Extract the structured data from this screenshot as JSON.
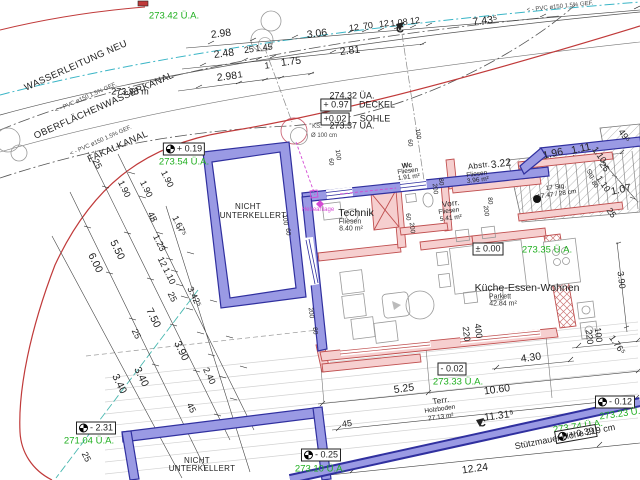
{
  "colors": {
    "wall_new_blue": "#9a9ae4",
    "wall_blue_edge": "#30309f",
    "wall_existing_pink": "#f6cfcf",
    "wall_pink_edge": "#c05050",
    "level_green": "#1faf1f",
    "boundary_red": "#c03a3a",
    "water_cyan": "#3ab5c6",
    "sewer_magenta": "#d44ad4",
    "hatch_gray": "#bbbbbb",
    "dim_black": "#333333",
    "drain_teal": "#49b8b0"
  },
  "labels": [
    {
      "n": "wasserleitung-label",
      "t": "WASSERLEITUNG NEU",
      "x": 76,
      "y": 66,
      "r": -24,
      "c": "util"
    },
    {
      "n": "pvc-note-1",
      "t": "< - PVC ø150 1.5% GEF.",
      "x": 86,
      "y": 98,
      "r": -24,
      "c": "t6"
    },
    {
      "n": "oberflaechenwasserkanal-label",
      "t": "OBERFLÄCHENWASSERKANAL",
      "x": 104,
      "y": 106,
      "r": -24,
      "c": "util"
    },
    {
      "n": "pvc-note-2",
      "t": "< - PVC ø150 1.5% GEF.",
      "x": 101,
      "y": 141,
      "r": -24,
      "c": "t6"
    },
    {
      "n": "faekalkanal-label",
      "t": "FÄKALKANAL",
      "x": 118,
      "y": 147,
      "r": -24,
      "c": "util"
    },
    {
      "n": "pvc-note-3",
      "t": "< - PVC ø150 1.5% GEF.",
      "x": 560,
      "y": 7,
      "r": -6,
      "c": "t6"
    },
    {
      "n": "level-27342",
      "t": "273.42 Ü.A.",
      "x": 174,
      "y": 16,
      "r": 0,
      "c": "g"
    },
    {
      "n": "level-27338",
      "t": "273.38 m",
      "x": 130,
      "y": 92,
      "r": 0,
      "c": "dim"
    },
    {
      "n": "level-box-019",
      "t": "+ 0.19",
      "x": 184,
      "y": 149,
      "r": 0,
      "c": "box",
      "m": true
    },
    {
      "n": "level-27354",
      "t": "273.54 Ü.A.",
      "x": 184,
      "y": 162,
      "r": 0,
      "c": "g"
    },
    {
      "n": "level-box-000",
      "t": "± 0.00",
      "x": 488,
      "y": 249,
      "r": 0,
      "c": "box"
    },
    {
      "n": "level-27335",
      "t": "273.35 Ü.A.",
      "x": 547,
      "y": 250,
      "r": 0,
      "c": "g"
    },
    {
      "n": "level-box-m002",
      "t": "- 0.02",
      "x": 452,
      "y": 369,
      "r": 0,
      "c": "box"
    },
    {
      "n": "level-27333",
      "t": "273.33 Ü.A.",
      "x": 458,
      "y": 382,
      "r": 0,
      "c": "g"
    },
    {
      "n": "level-box-m025",
      "t": "- 0.25",
      "x": 321,
      "y": 455,
      "r": 0,
      "c": "box",
      "m": true
    },
    {
      "n": "level-27310",
      "t": "273.10 Ü.A.",
      "x": 320,
      "y": 469,
      "r": 0,
      "c": "g"
    },
    {
      "n": "level-box-m231",
      "t": "- 2.31",
      "x": 96,
      "y": 428,
      "r": 0,
      "c": "box",
      "m": true
    },
    {
      "n": "level-27104",
      "t": "271.04 Ü.A.",
      "x": 89,
      "y": 441,
      "r": 0,
      "c": "g"
    },
    {
      "n": "level-27374",
      "t": "273.74 Ü.A.",
      "x": 578,
      "y": 427,
      "r": -8,
      "c": "g"
    },
    {
      "n": "level-box-m012",
      "t": "- 0.12",
      "x": 615,
      "y": 402,
      "r": 0,
      "c": "box",
      "m": true
    },
    {
      "n": "level-27323",
      "t": "273.23 Ü.A",
      "x": 623,
      "y": 414,
      "r": -8,
      "c": "g"
    },
    {
      "n": "level-box-039",
      "t": "+ 0.39",
      "x": 576,
      "y": 434,
      "r": -10,
      "c": "box",
      "m": true
    },
    {
      "n": "level-27432",
      "t": "274.32 ÜA.",
      "x": 352,
      "y": 96,
      "r": 0,
      "c": "dim"
    },
    {
      "n": "level-box-097",
      "t": "+ 0.97",
      "x": 336,
      "y": 105,
      "r": 0,
      "c": "box"
    },
    {
      "n": "deckel-label",
      "t": "DECKEL",
      "x": 377,
      "y": 105,
      "r": 0,
      "c": "dim"
    },
    {
      "n": "level-box-002",
      "t": "+0.02",
      "x": 335,
      "y": 119,
      "r": 0,
      "c": "box"
    },
    {
      "n": "sohle-label",
      "t": "SOHLE",
      "x": 375,
      "y": 119,
      "r": 0,
      "c": "dim"
    },
    {
      "n": "ks-label",
      "t": "KS.",
      "x": 317,
      "y": 127,
      "r": 0,
      "c": "t6"
    },
    {
      "n": "ks-diameter",
      "t": "Ø 100 cm",
      "x": 324,
      "y": 136,
      "r": 0,
      "c": "t6"
    },
    {
      "n": "level-27337",
      "t": "273.37 ÜA.",
      "x": 352,
      "y": 126,
      "r": 0,
      "c": "dim"
    },
    {
      "n": "room-nicht-1a",
      "t": "NICHT",
      "x": 248,
      "y": 207,
      "r": 0,
      "c": "rs"
    },
    {
      "n": "room-nicht-1b",
      "t": "UNTERKELLERT",
      "x": 253,
      "y": 216,
      "r": 0,
      "c": "rs"
    },
    {
      "n": "room-nicht-2a",
      "t": "NICHT",
      "x": 197,
      "y": 461,
      "r": 0,
      "c": "rs"
    },
    {
      "n": "room-nicht-2b",
      "t": "UNTERKELLERT",
      "x": 202,
      "y": 469,
      "r": 0,
      "c": "rs"
    },
    {
      "n": "room-technik",
      "t": "Technik",
      "x": 356,
      "y": 213,
      "r": 0,
      "c": "room"
    },
    {
      "n": "room-technik-floor",
      "t": "Fliesen",
      "x": 350,
      "y": 222,
      "r": 0,
      "c": "sub"
    },
    {
      "n": "room-technik-area",
      "t": "8.40 m²",
      "x": 351,
      "y": 229,
      "r": 0,
      "c": "sub"
    },
    {
      "n": "room-wc",
      "t": "Wc",
      "x": 407,
      "y": 166,
      "r": -7,
      "c": "rs2"
    },
    {
      "n": "room-wc-floor",
      "t": "Fliesen",
      "x": 408,
      "y": 172,
      "r": -7,
      "c": "t55"
    },
    {
      "n": "room-wc-area",
      "t": "1.91 m²",
      "x": 409,
      "y": 178,
      "r": -7,
      "c": "t55"
    },
    {
      "n": "room-abstr",
      "t": "Abstr.",
      "x": 479,
      "y": 166,
      "r": -7,
      "c": "rs"
    },
    {
      "n": "room-abstr-floor",
      "t": "Fliesen",
      "x": 477,
      "y": 175,
      "r": -7,
      "c": "t55"
    },
    {
      "n": "room-abstr-area",
      "t": "3.96 m²",
      "x": 478,
      "y": 181,
      "r": -7,
      "c": "t55"
    },
    {
      "n": "dim-322",
      "t": "3.22",
      "x": 501,
      "y": 164,
      "r": -8,
      "c": "dim11"
    },
    {
      "n": "room-vorr",
      "t": "Vorr.",
      "x": 451,
      "y": 204,
      "r": -7,
      "c": "rs"
    },
    {
      "n": "room-vorr-floor",
      "t": "Fliesen",
      "x": 449,
      "y": 212,
      "r": -7,
      "c": "t55"
    },
    {
      "n": "room-vorr-area",
      "t": "5.41 m²",
      "x": 451,
      "y": 219,
      "r": -7,
      "c": "t55"
    },
    {
      "n": "room-kueche",
      "t": "Küche-Essen-Wohnen",
      "x": 527,
      "y": 288,
      "r": 0,
      "c": "room"
    },
    {
      "n": "room-kueche-floor",
      "t": "Parkett",
      "x": 500,
      "y": 297,
      "r": 0,
      "c": "sub"
    },
    {
      "n": "room-kueche-area",
      "t": "42.84 m²",
      "x": 503,
      "y": 304,
      "r": 0,
      "c": "sub"
    },
    {
      "n": "room-terr",
      "t": "Terr.",
      "x": 441,
      "y": 401,
      "r": -8,
      "c": "rs"
    },
    {
      "n": "room-terr-floor",
      "t": "Holzboden",
      "x": 440,
      "y": 410,
      "r": -8,
      "c": "t55"
    },
    {
      "n": "room-terr-area",
      "t": "27.13 m²",
      "x": 441,
      "y": 418,
      "r": -8,
      "c": "t55"
    },
    {
      "n": "stair-count",
      "t": "17 Stg.",
      "x": 556,
      "y": 188,
      "r": -8,
      "c": "t55"
    },
    {
      "n": "stair-rise-run",
      "t": "17.47 / 28 cm",
      "x": 557,
      "y": 195,
      "r": -8,
      "c": "t55"
    },
    {
      "n": "hebeanlage-label",
      "t": "Hebeanlage",
      "x": 318,
      "y": 210,
      "r": 0,
      "c": "mag"
    },
    {
      "n": "stuetzmauer-label",
      "t": "Stützmauer Höhe 219 cm",
      "x": 565,
      "y": 437,
      "r": -11,
      "c": "dim"
    },
    {
      "n": "dim-298a",
      "t": "2.98",
      "x": 221,
      "y": 34,
      "r": -7,
      "c": "dim11"
    },
    {
      "n": "dim-306",
      "t": "3.06",
      "x": 317,
      "y": 34,
      "r": -7,
      "c": "dim11"
    },
    {
      "n": "dim-12a",
      "t": "12",
      "x": 354,
      "y": 28,
      "r": -7,
      "c": "dim"
    },
    {
      "n": "dim-70",
      "t": "70",
      "x": 368,
      "y": 26,
      "r": -7,
      "c": "dim"
    },
    {
      "n": "dim-12b",
      "t": "12",
      "x": 384,
      "y": 24,
      "r": -7,
      "c": "dim"
    },
    {
      "n": "dim-108",
      "t": "1.08",
      "x": 399,
      "y": 23,
      "r": -7,
      "c": "dim"
    },
    {
      "n": "dim-12c",
      "t": "12",
      "x": 415,
      "y": 21,
      "r": -7,
      "c": "dim"
    },
    {
      "n": "dim-743",
      "t": "7.43⁵",
      "x": 485,
      "y": 21,
      "r": -7,
      "c": "dim11"
    },
    {
      "n": "dim-248",
      "t": "2.48",
      "x": 224,
      "y": 54,
      "r": -7,
      "c": "dim11"
    },
    {
      "n": "dim-25a",
      "t": "25",
      "x": 249,
      "y": 50,
      "r": -7,
      "c": "dim"
    },
    {
      "n": "dim-145",
      "t": "1.45",
      "x": 264,
      "y": 48,
      "r": -7,
      "c": "dim"
    },
    {
      "n": "dim-281",
      "t": "2.81",
      "x": 350,
      "y": 51,
      "r": -7,
      "c": "dim11"
    },
    {
      "n": "dim-298b",
      "t": "2.98",
      "x": 227,
      "y": 77,
      "r": -7,
      "c": "dim11"
    },
    {
      "n": "dim-1a",
      "t": "1",
      "x": 240,
      "y": 75,
      "r": -7,
      "c": "dim"
    },
    {
      "n": "dim-1b",
      "t": "1",
      "x": 267,
      "y": 66,
      "r": -7,
      "c": "dim"
    },
    {
      "n": "dim-175",
      "t": "1.75",
      "x": 291,
      "y": 62,
      "r": -7,
      "c": "dim11"
    },
    {
      "n": "section-marker-c1",
      "t": "C",
      "x": 400,
      "y": 30,
      "r": 0,
      "c": "dimb"
    },
    {
      "n": "section-marker-c2",
      "t": "C",
      "x": 482,
      "y": 424,
      "r": 0,
      "c": "dimb"
    },
    {
      "n": "dim-25b",
      "t": "25",
      "x": 97,
      "y": 164,
      "r": 64,
      "c": "dim"
    },
    {
      "n": "dim-190a",
      "t": "1.90",
      "x": 167,
      "y": 179,
      "r": 64,
      "c": "dim"
    },
    {
      "n": "dim-190b",
      "t": "1.90",
      "x": 146,
      "y": 189,
      "r": 64,
      "c": "dim"
    },
    {
      "n": "dim-190c",
      "t": "1.90",
      "x": 124,
      "y": 189,
      "r": 64,
      "c": "dim"
    },
    {
      "n": "dim-45a",
      "t": "45",
      "x": 152,
      "y": 217,
      "r": 64,
      "c": "dim"
    },
    {
      "n": "dim-167",
      "t": "1.67⁵",
      "x": 179,
      "y": 226,
      "r": 64,
      "c": "dim"
    },
    {
      "n": "dim-123",
      "t": "1.23",
      "x": 159,
      "y": 243,
      "r": 64,
      "c": "dim"
    },
    {
      "n": "dim-12d",
      "t": "12",
      "x": 162,
      "y": 262,
      "r": 64,
      "c": "dim"
    },
    {
      "n": "dim-110a",
      "t": "1.10",
      "x": 169,
      "y": 276,
      "r": 64,
      "c": "dim"
    },
    {
      "n": "dim-25c",
      "t": "25",
      "x": 172,
      "y": 297,
      "r": 64,
      "c": "dim"
    },
    {
      "n": "dim-550",
      "t": "5.50",
      "x": 117,
      "y": 250,
      "r": 64,
      "c": "dim11"
    },
    {
      "n": "dim-600",
      "t": "6.00",
      "x": 95,
      "y": 263,
      "r": 64,
      "c": "dim11"
    },
    {
      "n": "dim-342",
      "t": "3.42⁵",
      "x": 194,
      "y": 297,
      "r": 64,
      "c": "dim"
    },
    {
      "n": "dim-750",
      "t": "7.50",
      "x": 153,
      "y": 318,
      "r": 64,
      "c": "dim11"
    },
    {
      "n": "dim-25d",
      "t": "25",
      "x": 136,
      "y": 334,
      "r": 64,
      "c": "dim"
    },
    {
      "n": "dim-390a",
      "t": "3.90",
      "x": 181,
      "y": 351,
      "r": 64,
      "c": "dim11"
    },
    {
      "n": "dim-340a",
      "t": "3.40",
      "x": 141,
      "y": 377,
      "r": 64,
      "c": "dim11"
    },
    {
      "n": "dim-340b",
      "t": "3.40",
      "x": 119,
      "y": 384,
      "r": 64,
      "c": "dim11"
    },
    {
      "n": "dim-240",
      "t": "2.40",
      "x": 209,
      "y": 376,
      "r": 64,
      "c": "dim"
    },
    {
      "n": "dim-45b",
      "t": "45",
      "x": 191,
      "y": 408,
      "r": 64,
      "c": "dim"
    },
    {
      "n": "dim-25e",
      "t": "25",
      "x": 86,
      "y": 457,
      "r": 64,
      "c": "dim"
    },
    {
      "n": "dim-196",
      "t": "1.96",
      "x": 553,
      "y": 154,
      "r": -12,
      "c": "dim11"
    },
    {
      "n": "dim-111",
      "t": "1.11",
      "x": 581,
      "y": 149,
      "r": -12,
      "c": "dim11"
    },
    {
      "n": "dim-49",
      "t": "49⁵",
      "x": 624,
      "y": 136,
      "r": 55,
      "c": "dim"
    },
    {
      "n": "dim-110b",
      "t": "1.10",
      "x": 599,
      "y": 155,
      "r": 55,
      "c": "dim"
    },
    {
      "n": "dim-25f",
      "t": "25",
      "x": 604,
      "y": 167,
      "r": 55,
      "c": "dim"
    },
    {
      "n": "stair-stg-label",
      "t": "Stg.",
      "x": 590,
      "y": 175,
      "r": 55,
      "c": "t55"
    },
    {
      "n": "dim-80a",
      "t": "80",
      "x": 594,
      "y": 185,
      "r": 55,
      "c": "t55"
    },
    {
      "n": "dim-110c",
      "t": "1.10",
      "x": 603,
      "y": 184,
      "r": 55,
      "c": "dim"
    },
    {
      "n": "dim-107",
      "t": "1.07",
      "x": 621,
      "y": 190,
      "r": -12,
      "c": "dim11"
    },
    {
      "n": "dim-25g",
      "t": "25",
      "x": 611,
      "y": 213,
      "r": 55,
      "c": "dim"
    },
    {
      "n": "dim-390b",
      "t": "3.90",
      "x": 621,
      "y": 280,
      "r": 83,
      "c": "dim"
    },
    {
      "n": "dim-220a",
      "t": "220",
      "x": 466,
      "y": 334,
      "r": 83,
      "c": "dim"
    },
    {
      "n": "dim-400",
      "t": "400",
      "x": 478,
      "y": 331,
      "r": 83,
      "c": "dim"
    },
    {
      "n": "dim-220b",
      "t": "220",
      "x": 589,
      "y": 337,
      "r": 83,
      "c": "dim"
    },
    {
      "n": "dim-100a",
      "t": "100",
      "x": 598,
      "y": 335,
      "r": 83,
      "c": "dim"
    },
    {
      "n": "dim-176",
      "t": "1.76⁵",
      "x": 617,
      "y": 345,
      "r": 55,
      "c": "dim"
    },
    {
      "n": "dim-430",
      "t": "4.30",
      "x": 531,
      "y": 358,
      "r": -8,
      "c": "dim11"
    },
    {
      "n": "dim-525",
      "t": "5.25",
      "x": 404,
      "y": 389,
      "r": -8,
      "c": "dim11"
    },
    {
      "n": "dim-1060",
      "t": "10.60",
      "x": 497,
      "y": 390,
      "r": -8,
      "c": "dim11"
    },
    {
      "n": "dim-1131",
      "t": "11.31⁵",
      "x": 499,
      "y": 416,
      "r": -8,
      "c": "dim11"
    },
    {
      "n": "dim-45c",
      "t": "45",
      "x": 347,
      "y": 424,
      "r": -8,
      "c": "dim"
    },
    {
      "n": "dim-1224",
      "t": "12.24",
      "x": 475,
      "y": 469,
      "r": -8,
      "c": "dim11"
    },
    {
      "n": "door-dim-60a",
      "t": "60",
      "x": 407,
      "y": 217,
      "r": 83,
      "c": "t55"
    },
    {
      "n": "door-dim-200a",
      "t": "200",
      "x": 411,
      "y": 228,
      "r": 83,
      "c": "t55"
    },
    {
      "n": "door-dim-80b",
      "t": "80",
      "x": 489,
      "y": 201,
      "r": 83,
      "c": "t55"
    },
    {
      "n": "door-dim-200b",
      "t": "200",
      "x": 485,
      "y": 211,
      "r": 83,
      "c": "t55"
    },
    {
      "n": "door-dim-80c",
      "t": "80",
      "x": 440,
      "y": 182,
      "r": 83,
      "c": "t55"
    },
    {
      "n": "door-dim-200c",
      "t": "200",
      "x": 434,
      "y": 189,
      "r": 83,
      "c": "t55"
    },
    {
      "n": "win-dim-60b",
      "t": "60",
      "x": 330,
      "y": 162,
      "r": 83,
      "c": "t55"
    },
    {
      "n": "win-dim-100b",
      "t": "100",
      "x": 337,
      "y": 155,
      "r": 83,
      "c": "t55"
    },
    {
      "n": "win-dim-60c",
      "t": "60",
      "x": 409,
      "y": 143,
      "r": 83,
      "c": "t55"
    },
    {
      "n": "win-dim-100c",
      "t": "100",
      "x": 417,
      "y": 134,
      "r": 83,
      "c": "t55"
    },
    {
      "n": "win-dim-200d",
      "t": "200",
      "x": 310,
      "y": 313,
      "r": 83,
      "c": "t55"
    },
    {
      "n": "win-dim-80d",
      "t": "80",
      "x": 314,
      "y": 331,
      "r": 83,
      "c": "t55"
    },
    {
      "n": "win-dim-100d",
      "t": "100",
      "x": 284,
      "y": 220,
      "r": 83,
      "c": "t55"
    },
    {
      "n": "win-dim-60d",
      "t": "60",
      "x": 287,
      "y": 232,
      "r": 83,
      "c": "t55"
    }
  ]
}
